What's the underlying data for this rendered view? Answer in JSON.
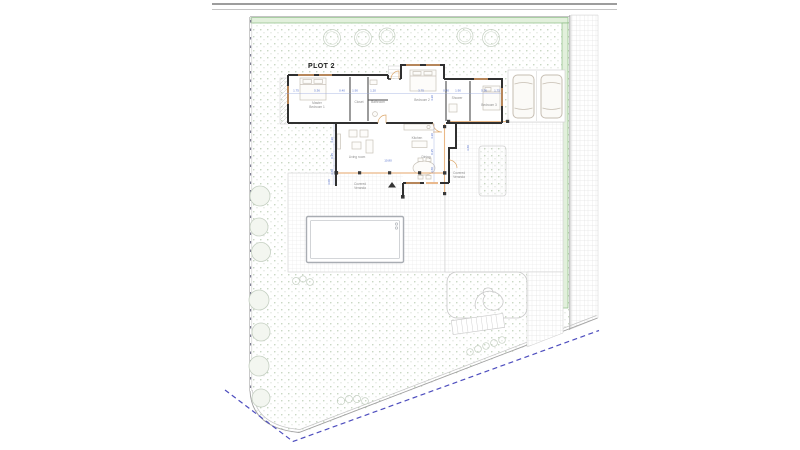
{
  "plan": {
    "title": "PLOT 2",
    "rooms": {
      "master_bedroom": [
        "Master",
        "Bedroom 1"
      ],
      "closet": "Closet",
      "bathroom": "Bathroom",
      "bedroom2": "Bedroom 2",
      "shower": "Shower",
      "bedroom3": "Bedroom 3",
      "kitchen": "Kitchen",
      "living_room": "Living room",
      "dining": "Dining",
      "covered_veranda_south": [
        "Covered",
        "Veranda"
      ],
      "covered_veranda_east": [
        "Covered",
        "Veranda"
      ]
    },
    "dimensions": {
      "top_row": [
        "1.75",
        "5.36",
        "0.40",
        "1.90",
        "1.20",
        "3.75",
        "0.40",
        "1.90",
        "5.36",
        "1.75"
      ],
      "living_width": "10.80",
      "left_stack": [
        "4.20",
        "0.25",
        "3.60"
      ],
      "right_stack": [
        "4.20",
        "0.25",
        "3.60"
      ],
      "east": "3.60",
      "bedroom2_height": "4.20",
      "veranda_depth": "3.00"
    }
  },
  "colors": {
    "wall": "#303030",
    "dimension_blue": "#5570cc",
    "boundary_dash_blue": "#4d4dbe",
    "hedge_green": "#8cbd84",
    "joinery_orange": "#e3a368"
  }
}
